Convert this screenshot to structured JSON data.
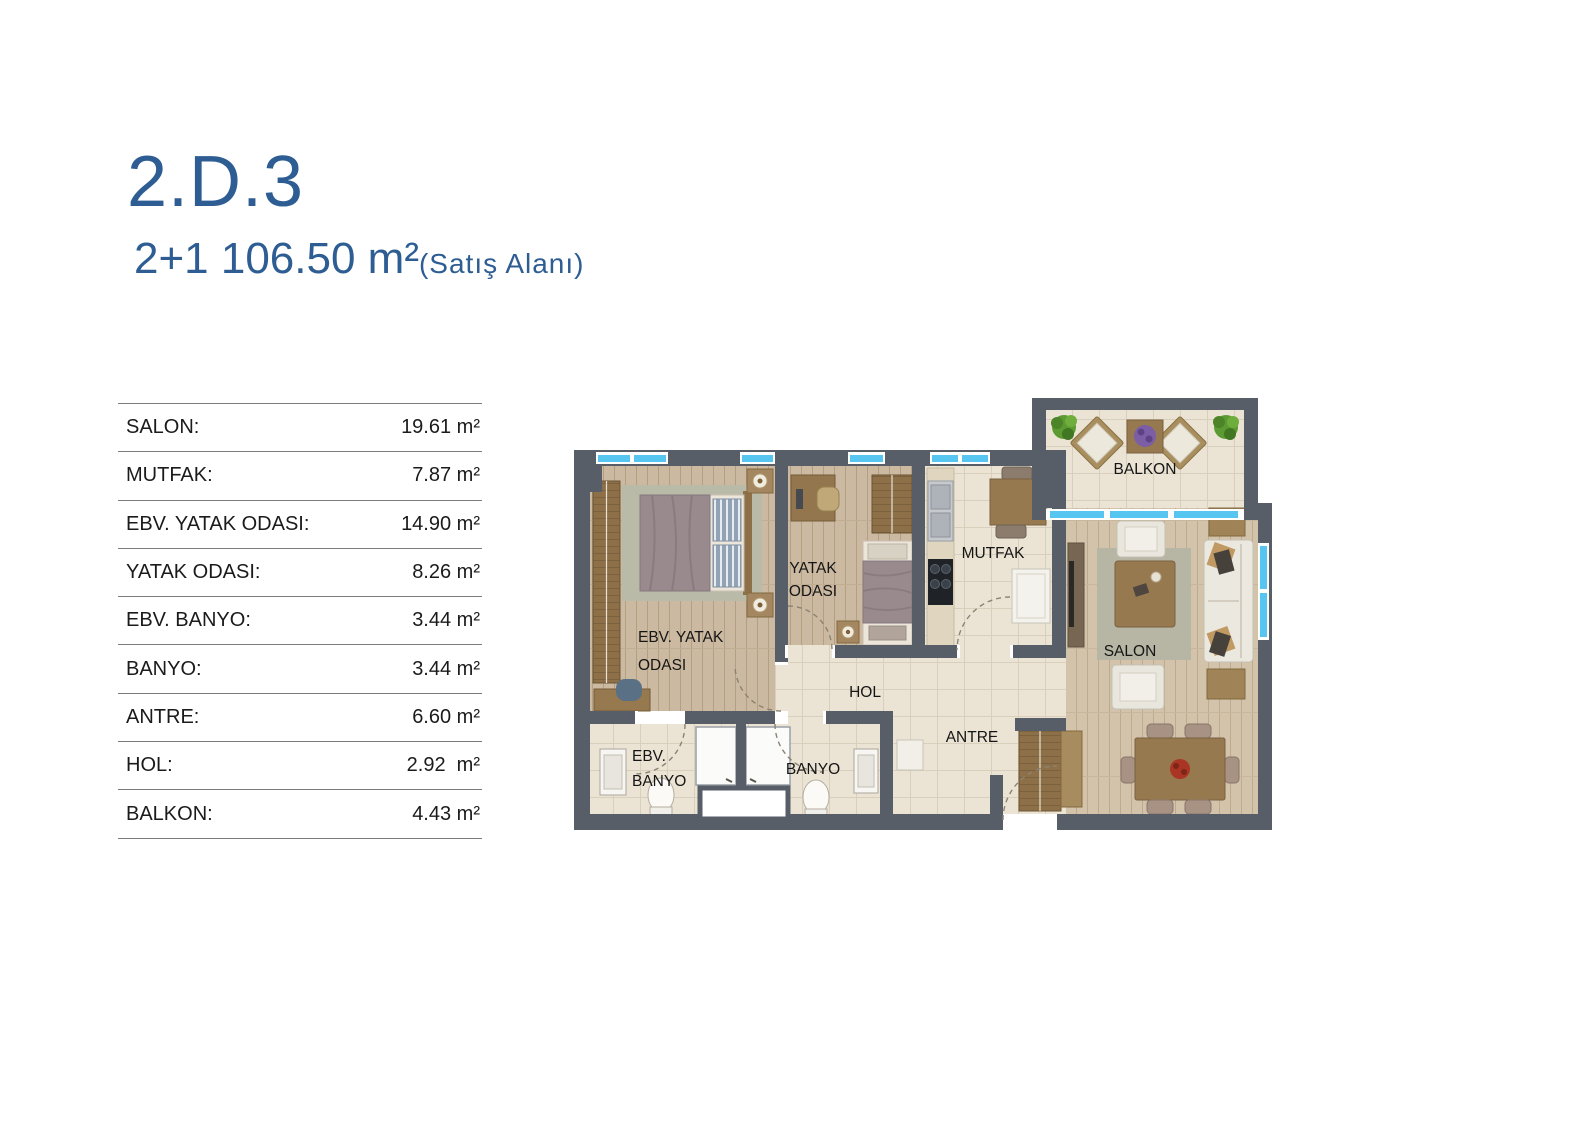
{
  "header": {
    "unit_code": "2.D.3",
    "spec": "2+1 106.50 m²",
    "spec_note": "(Satış Alanı)"
  },
  "area_table": {
    "rows": [
      {
        "label": "SALON:",
        "value": "19.61 m²"
      },
      {
        "label": "MUTFAK:",
        "value": "7.87 m²"
      },
      {
        "label": "EBV. YATAK ODASI:",
        "value": "14.90 m²"
      },
      {
        "label": "YATAK ODASI:",
        "value": "8.26 m²"
      },
      {
        "label": "EBV. BANYO:",
        "value": "3.44 m²"
      },
      {
        "label": "BANYO:",
        "value": "3.44 m²"
      },
      {
        "label": "ANTRE:",
        "value": "6.60 m²"
      },
      {
        "label": "HOL:",
        "value": "2.92  m²"
      },
      {
        "label": "BALKON:",
        "value": "4.43 m²"
      }
    ]
  },
  "floor_plan": {
    "labels": {
      "balkon": "BALKON",
      "mutfak": "MUTFAK",
      "yatak_line1": "YATAK",
      "yatak_line2": "ODASI",
      "ebv_yatak_line1": "EBV. YATAK",
      "ebv_yatak_line2": "ODASI",
      "salon": "SALON",
      "hol": "HOL",
      "antre": "ANTRE",
      "ebv_banyo_line1": "EBV.",
      "ebv_banyo_line2": "BANYO",
      "banyo": "BANYO"
    },
    "colors": {
      "wall": "#575e68",
      "window_blue": "#56c6f0",
      "wood_floor": "#cbb9a1",
      "salon_floor": "#d3c3ab",
      "tile_floor": "#ebe4d5",
      "rug": "#b7b5a3",
      "furniture_wood": "#97794f",
      "title_blue": "#2d5d92"
    }
  }
}
